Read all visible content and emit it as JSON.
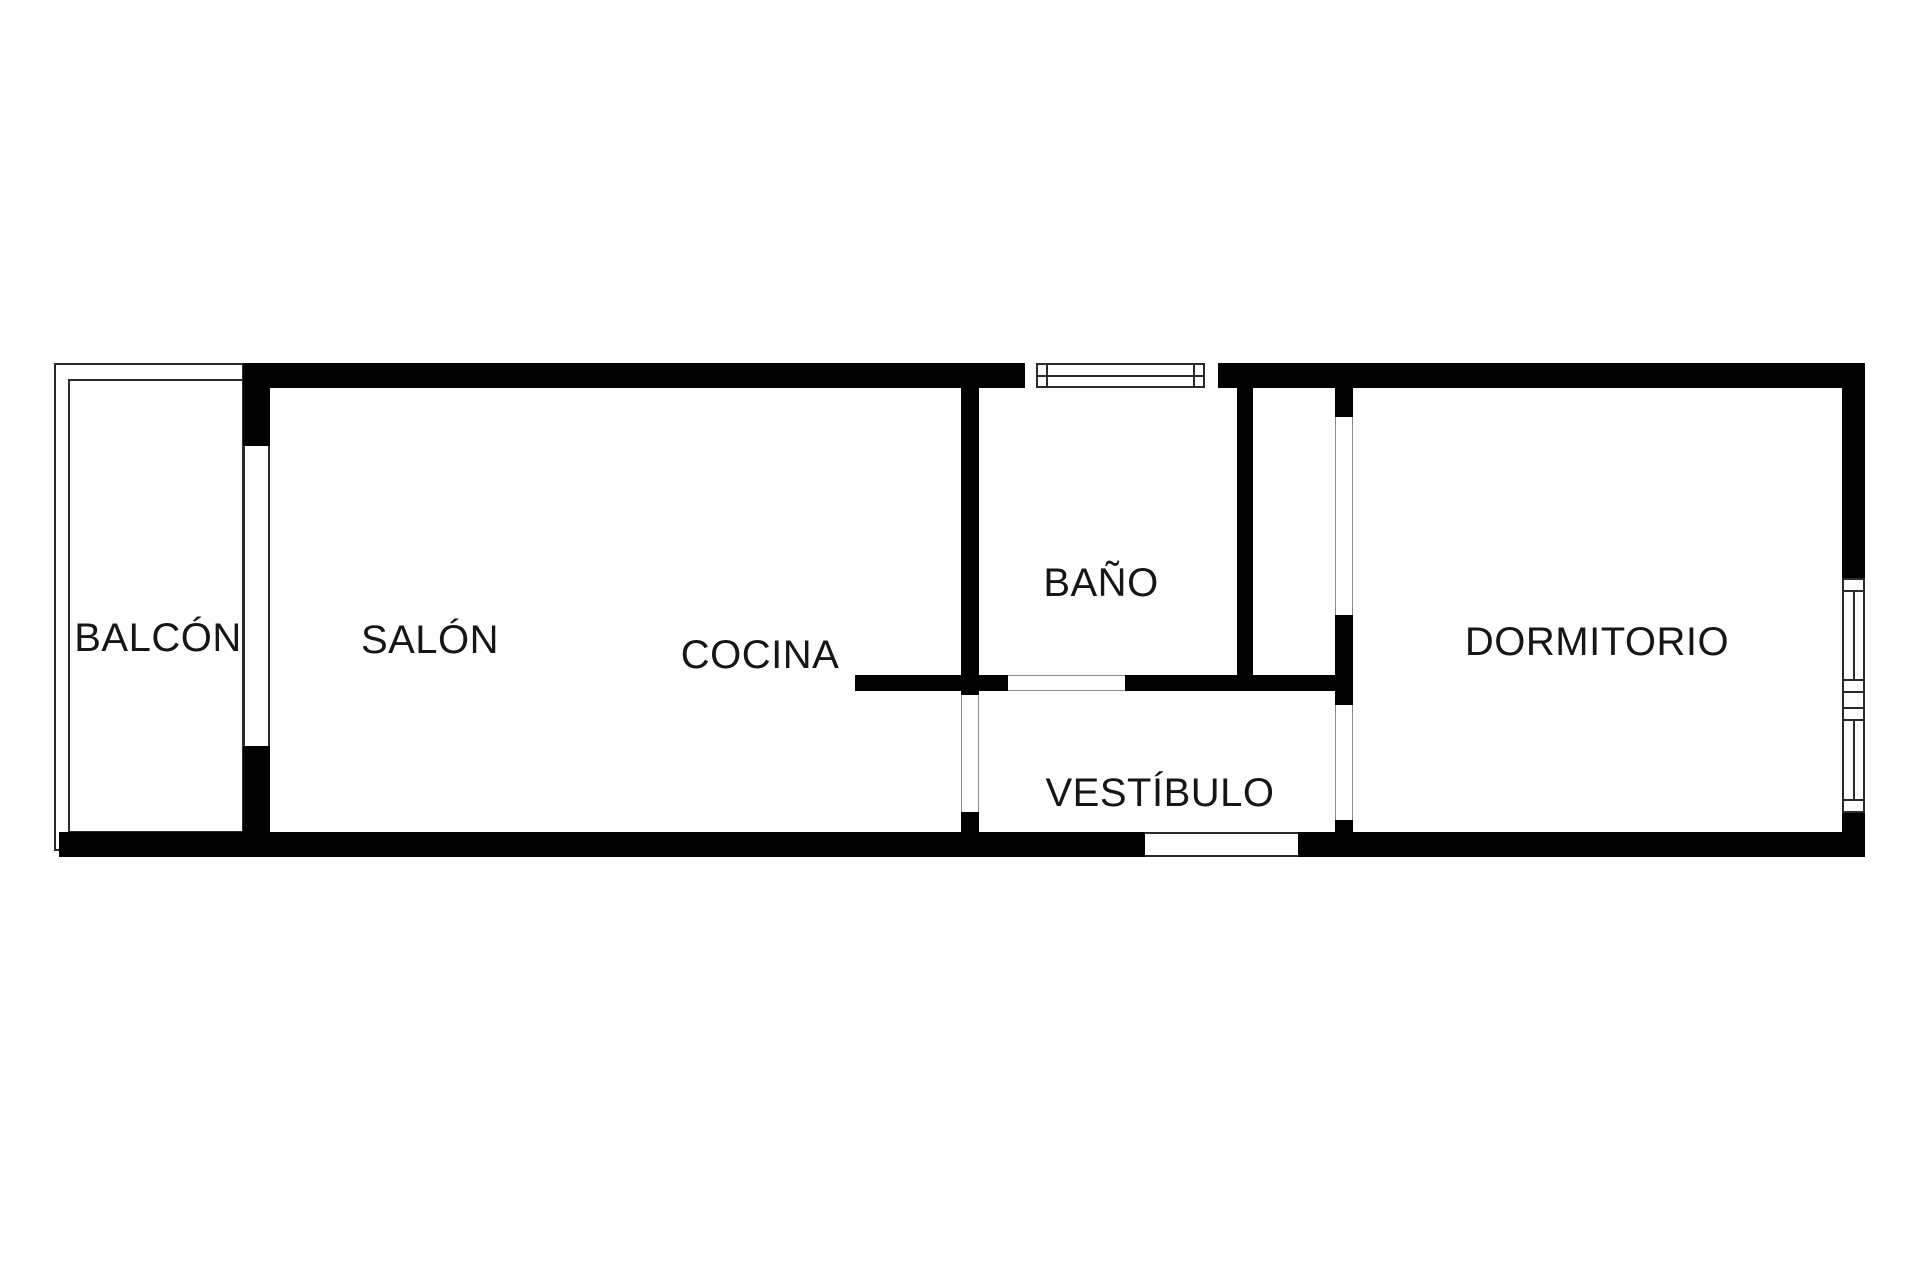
{
  "palette": {
    "background": "#ffffff",
    "wall": "#000000",
    "thin": "#2b2b2b",
    "faint": "#8a8a8a",
    "text": "#161616"
  },
  "rooms": [
    {
      "id": "balcon",
      "label": "BALCÓN"
    },
    {
      "id": "salon",
      "label": "SALÓN"
    },
    {
      "id": "cocina",
      "label": "COCINA"
    },
    {
      "id": "bano",
      "label": "BAÑO"
    },
    {
      "id": "vestibulo",
      "label": "VESTÍBULO"
    },
    {
      "id": "dormitorio",
      "label": "DORMITORIO"
    }
  ]
}
